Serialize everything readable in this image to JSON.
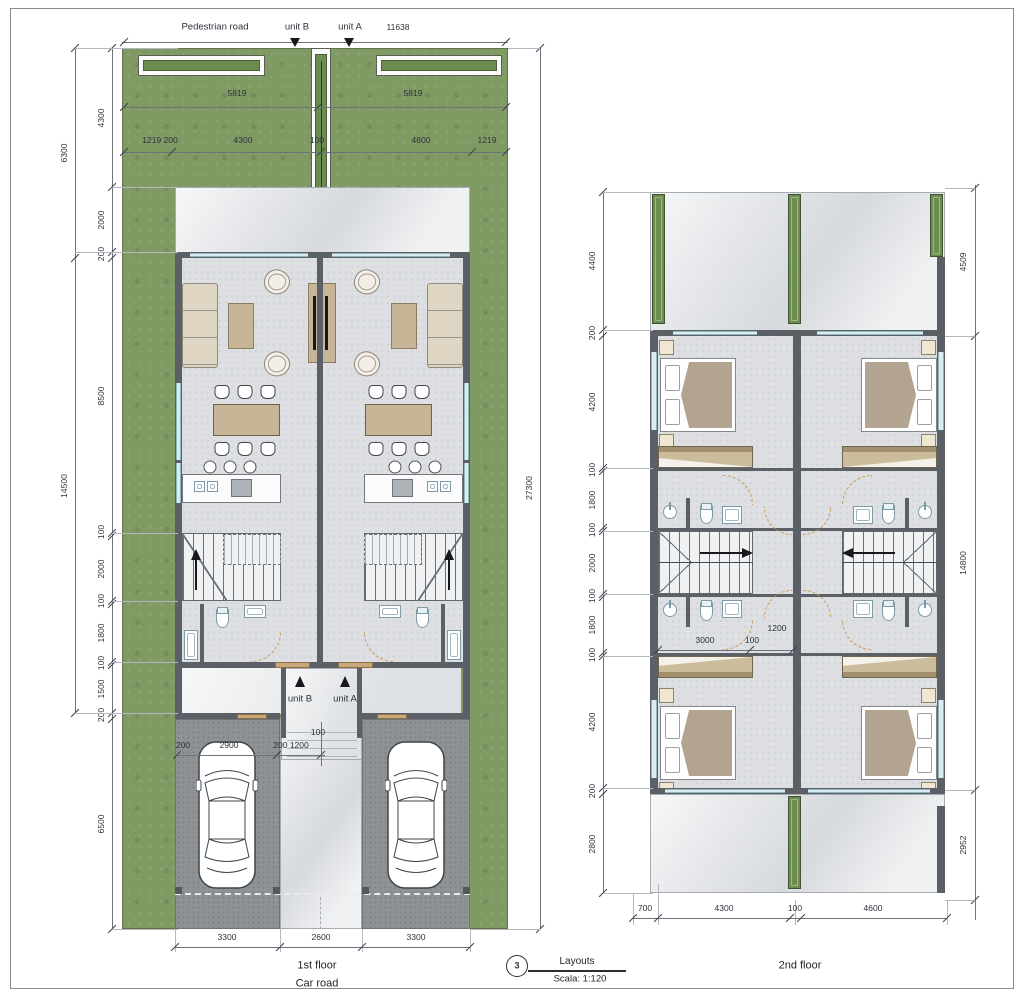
{
  "p1": {
    "top": {
      "road": "Pedestrian road",
      "unit_b": "unit B",
      "unit_a": "unit A",
      "total": "11638"
    },
    "garden": {
      "left": "5819",
      "right": "5819"
    },
    "row3": [
      "1219 200",
      "4300",
      "100",
      "4600",
      "1219"
    ],
    "left_outer": [
      "6300",
      "14500"
    ],
    "right_total": "27300",
    "left_inner": [
      "4300",
      "2000",
      "200",
      "8500",
      "100",
      "2000",
      "100",
      "1800",
      "100",
      "1500",
      "200",
      "6500"
    ],
    "entry": {
      "unit_b": "unit B",
      "unit_a": "unit A",
      "gap": "100"
    },
    "car_dims": [
      "200",
      "2900",
      "200 1200"
    ],
    "bottom": [
      "3300",
      "2600",
      "3300"
    ],
    "floor_label": "1st floor",
    "road_label": "Car road"
  },
  "p2": {
    "left_inner": [
      "4400",
      "200",
      "4200",
      "100",
      "1800",
      "100",
      "2000",
      "100",
      "1800",
      "100",
      "4200",
      "200",
      "2800"
    ],
    "right": [
      "4509",
      "14800",
      "2952"
    ],
    "mid": [
      "3000",
      "100",
      "1200"
    ],
    "bottom": [
      "700",
      "4300",
      "100",
      "4600"
    ],
    "floor_label": "2nd floor"
  },
  "title_block": {
    "number": "3",
    "name": "Layouts",
    "scale": "Scala: 1:120"
  },
  "colors": {
    "grass": "#809a64",
    "wall": "#5b6066",
    "wood": "#c6b697",
    "door_accent": "#cf9a55",
    "planter": "#6d8d50",
    "marble": "#e4e6e9",
    "asphalt": "#8f9295",
    "window": "#d9edf0"
  }
}
